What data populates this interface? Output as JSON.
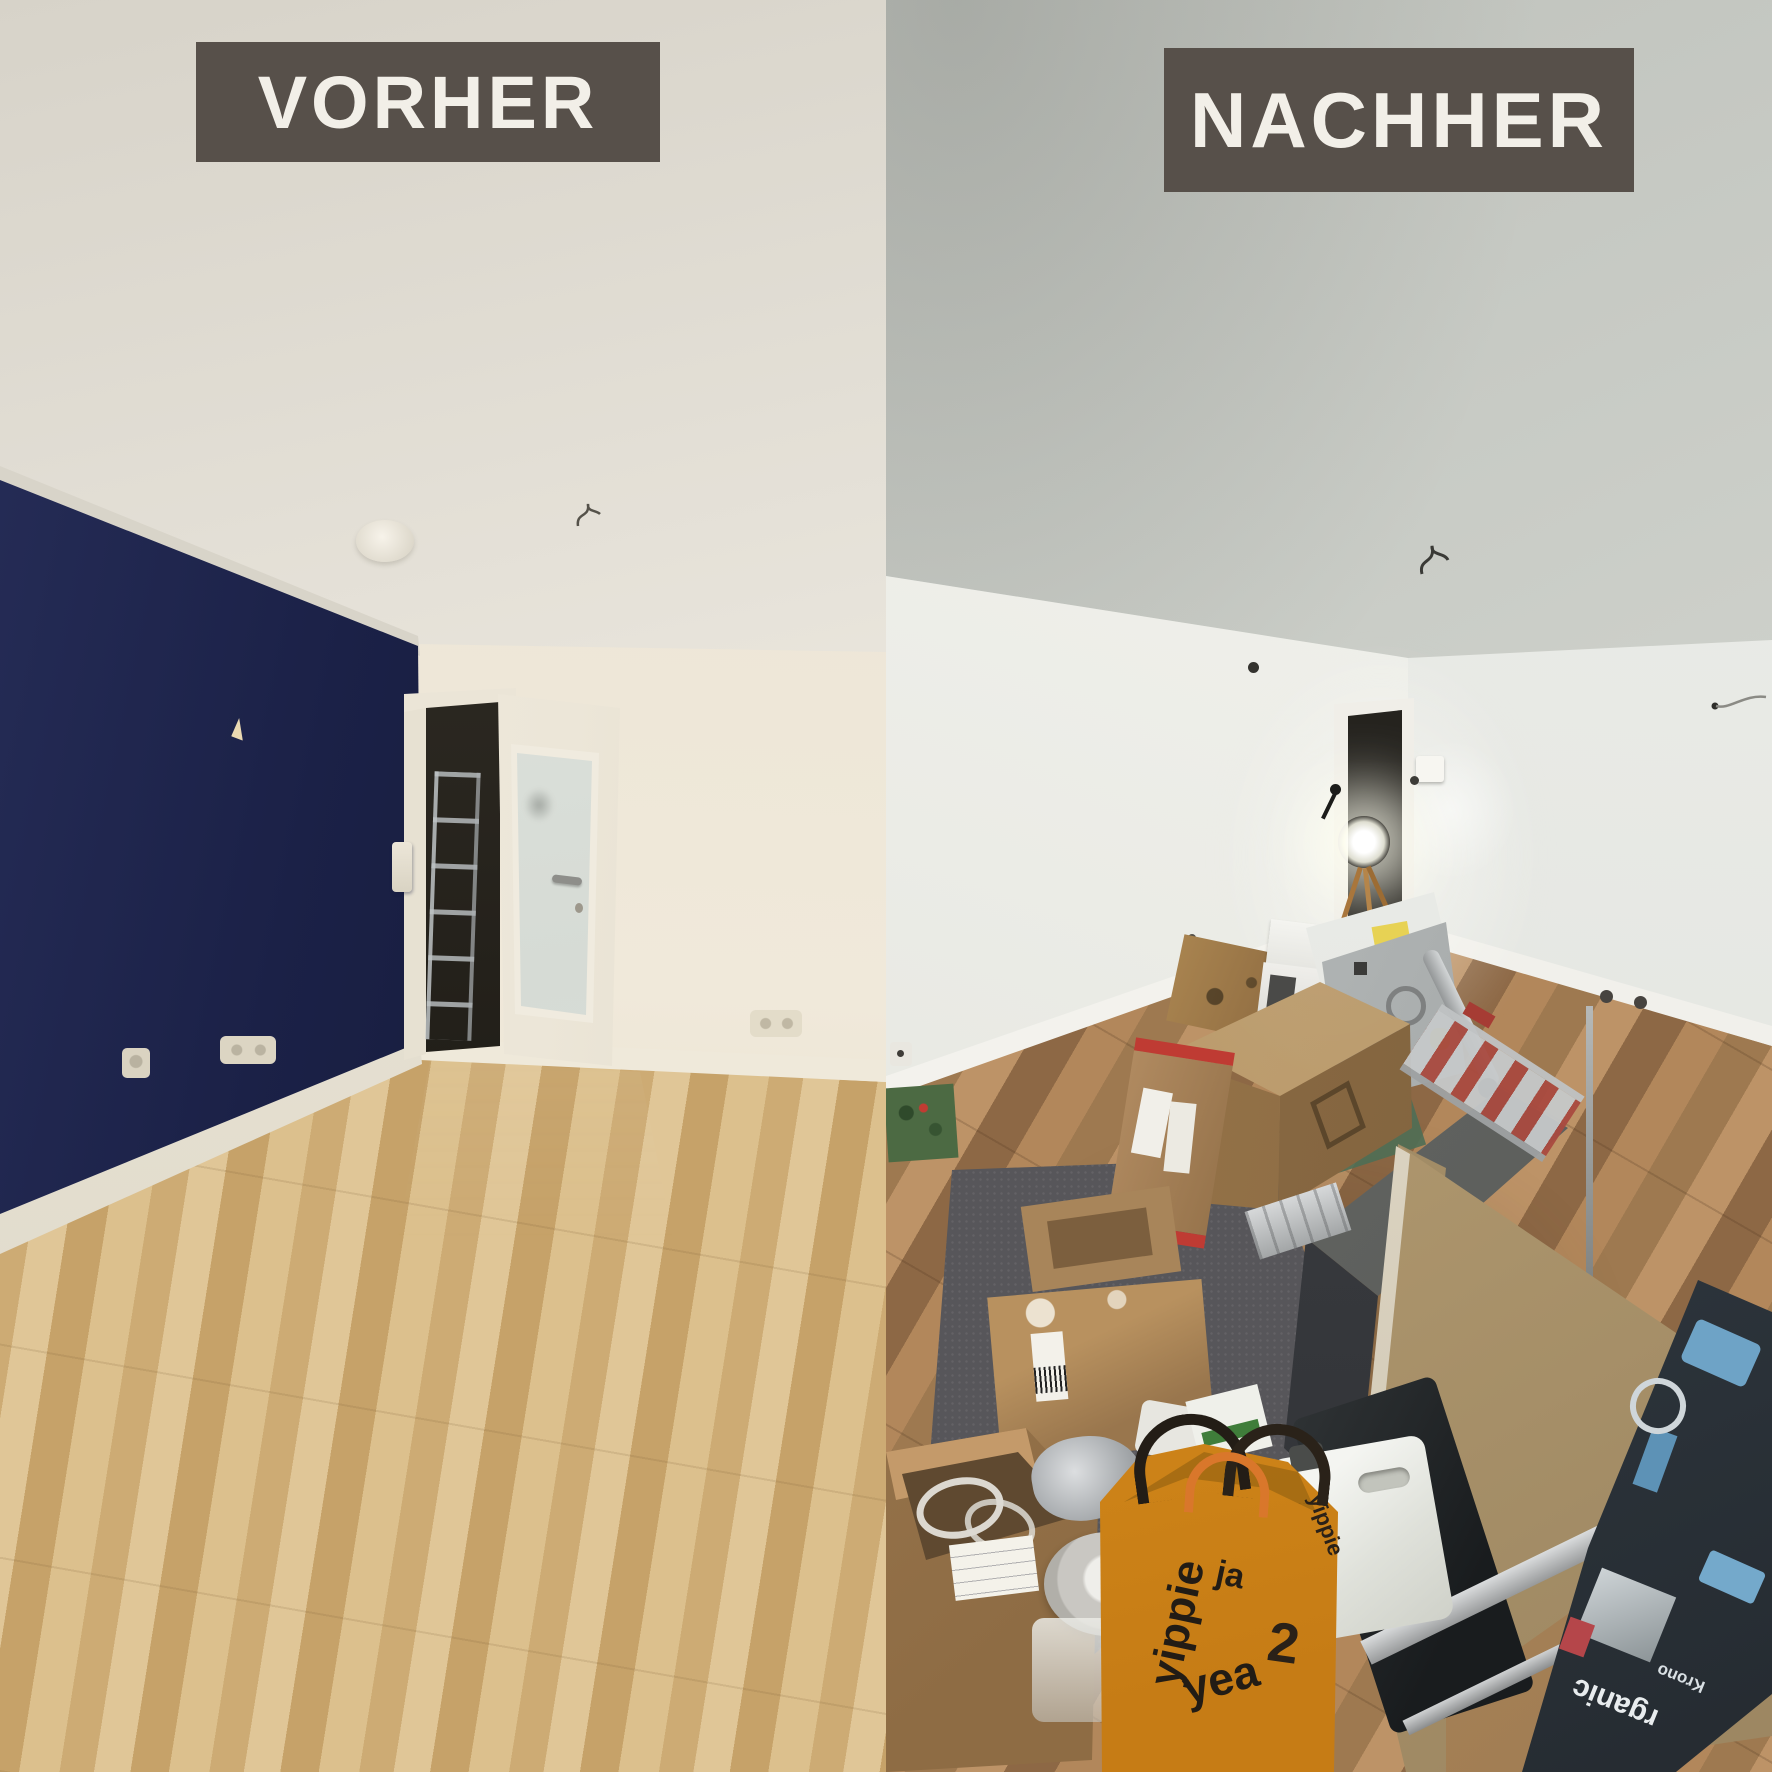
{
  "image_type": "before-after renovation photo collage",
  "labels": {
    "before": "VORHER",
    "after": "NACHHER"
  },
  "label_style": {
    "background": "#57504a",
    "text_color": "#f2efe8"
  },
  "before_scene": {
    "name": "empty living room before renovation",
    "accent_wall_color": "#1b2147",
    "ceiling_color": "#e7e3da",
    "wall_color": "#ece5d7",
    "floor_color": "#d4b681",
    "floor_material": "light oak laminate",
    "door": "open white door with frosted glass panel",
    "details": [
      "smoke detector on ceiling",
      "ladder in dark hallway behind door",
      "power outlets and light switch",
      "white baseboards"
    ]
  },
  "after_scene": {
    "name": "freshly renovated room with moving boxes",
    "ceiling_color": "#cdd0ca",
    "wall_color": "#f0f0eb",
    "floor_color": "#a87e53",
    "floor_material": "new oak vinyl plank",
    "details": [
      "work light on tripod in doorway",
      "pile of cardboard boxes",
      "white appliance box with yellow label",
      "red-edged flat carton",
      "gray sheet-metal box",
      "aluminium ladder and pipe",
      "leaning MDF board",
      "metal rails",
      "dark toolbox",
      "laminate flooring package",
      "white canister",
      "paint can and glass jar",
      "gray moving blanket",
      "open box with white cables",
      "yellow shopping bag"
    ]
  },
  "bag": {
    "words": [
      "yippie",
      "ja",
      "yea",
      "2"
    ]
  },
  "laminate_package": {
    "brand_top": "rganic",
    "brand_bottom": "Krono"
  }
}
